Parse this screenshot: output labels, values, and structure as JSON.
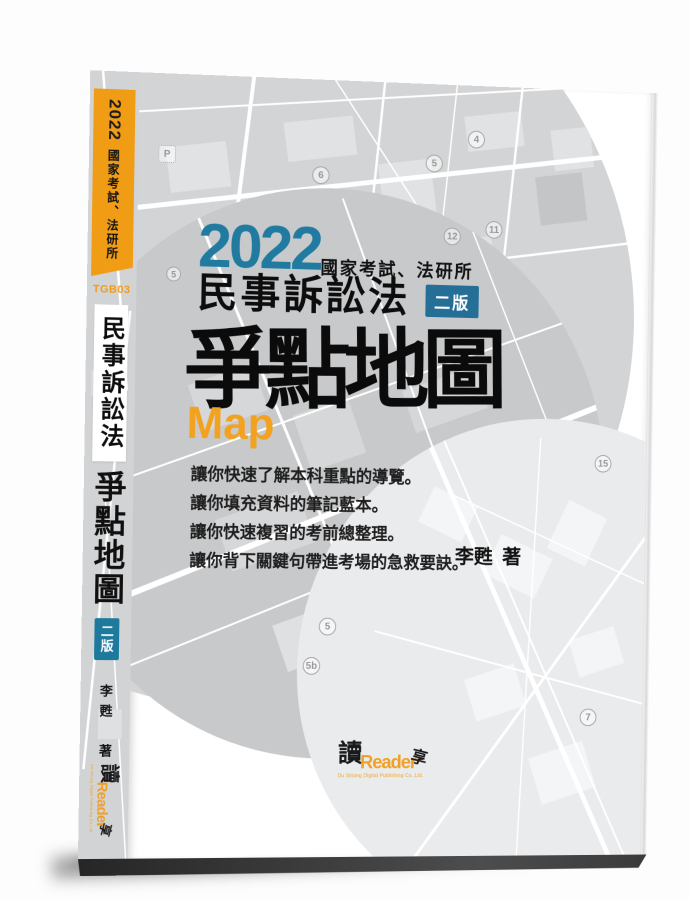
{
  "book": {
    "year": "2022",
    "exam_label": "國家考試、法研所",
    "code": "TGB03",
    "subject": "民事訴訟法",
    "edition": "二版",
    "title": "爭點地圖",
    "title_latin": "Map",
    "bullets": [
      "讓你快速了解本科重點的導覽。",
      "讓你填充資料的筆記藍本。",
      "讓你快速複習的考前總整理。",
      "讓你背下關鍵句帶進考場的急救要訣。"
    ],
    "author": "李甦",
    "author_suffix": "著"
  },
  "publisher": {
    "logo_char": "讀",
    "logo_text": "Reader",
    "logo_char2": "享",
    "tagline": "Du Shiang Digital Publishing Co.,Ltd."
  },
  "map_markers": [
    "P",
    "5",
    "6",
    "4",
    "12",
    "11",
    "5",
    "5",
    "5b",
    "15",
    "7"
  ],
  "colors": {
    "accent_orange": "#F19C15",
    "accent_blue": "#1E7A9D",
    "year_blue": "#217BA0",
    "map_gray": "#D3D4D6",
    "map_dark": "#C8C9CB",
    "map_light": "#EAEBED"
  }
}
